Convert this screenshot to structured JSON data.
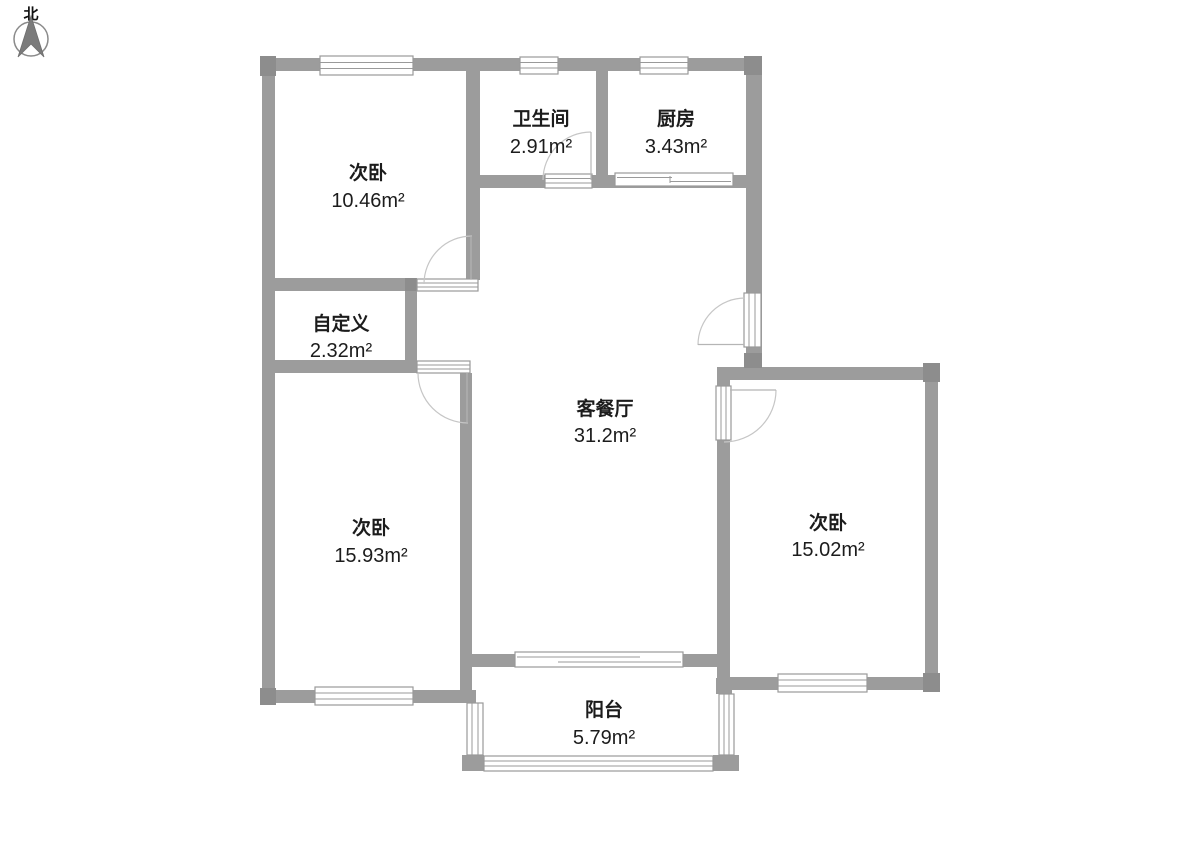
{
  "compass": {
    "label": "北"
  },
  "colors": {
    "wall": "#9c9c9c",
    "wall_corner": "#8d8d8d",
    "window_frame": "#9a9a9a",
    "door_arc": "#c6c6c6",
    "text": "#1c1c1c",
    "background": "#ffffff"
  },
  "rooms": [
    {
      "name": "次卧",
      "area": "10.46m²"
    },
    {
      "name": "卫生间",
      "area": "2.91m²"
    },
    {
      "name": "厨房",
      "area": "3.43m²"
    },
    {
      "name": "自定义",
      "area": "2.32m²"
    },
    {
      "name": "客餐厅",
      "area": "31.2m²"
    },
    {
      "name": "次卧",
      "area": "15.93m²"
    },
    {
      "name": "次卧",
      "area": "15.02m²"
    },
    {
      "name": "阳台",
      "area": "5.79m²"
    }
  ]
}
